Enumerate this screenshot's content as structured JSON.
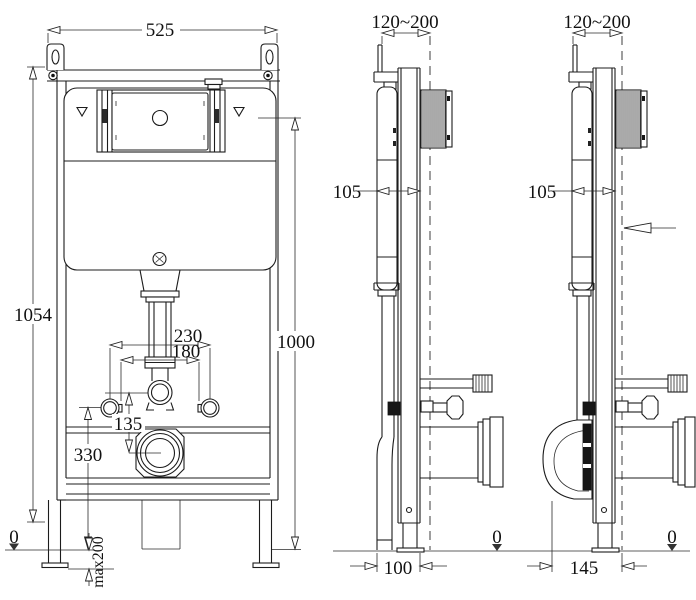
{
  "drawing_type": "technical-installation-diagram",
  "product": "concealed-cistern-wall-mount-frame",
  "views": {
    "front": {
      "name": "front-view",
      "dimensions": {
        "overall_width": "525",
        "overall_height": "1054",
        "flush_panel_center_height": "1000",
        "fixing_bolt_spacing_wide": "230",
        "fixing_bolt_spacing_narrow": "180",
        "flush_to_outlet_distance": "135",
        "outlet_bracket_height": "330",
        "leg_extension": "max200",
        "floor_level": "0"
      }
    },
    "side_floor_outlet": {
      "name": "side-view-floor-outlet",
      "dimensions": {
        "wall_depth_range": "120~200",
        "frame_depth": "105",
        "outlet_to_frame": "100",
        "floor_level": "0"
      }
    },
    "side_wall_outlet": {
      "name": "side-view-wall-outlet",
      "dimensions": {
        "wall_depth_range": "120~200",
        "frame_depth": "105",
        "outlet_to_wall": "145",
        "floor_level": "0"
      }
    }
  }
}
